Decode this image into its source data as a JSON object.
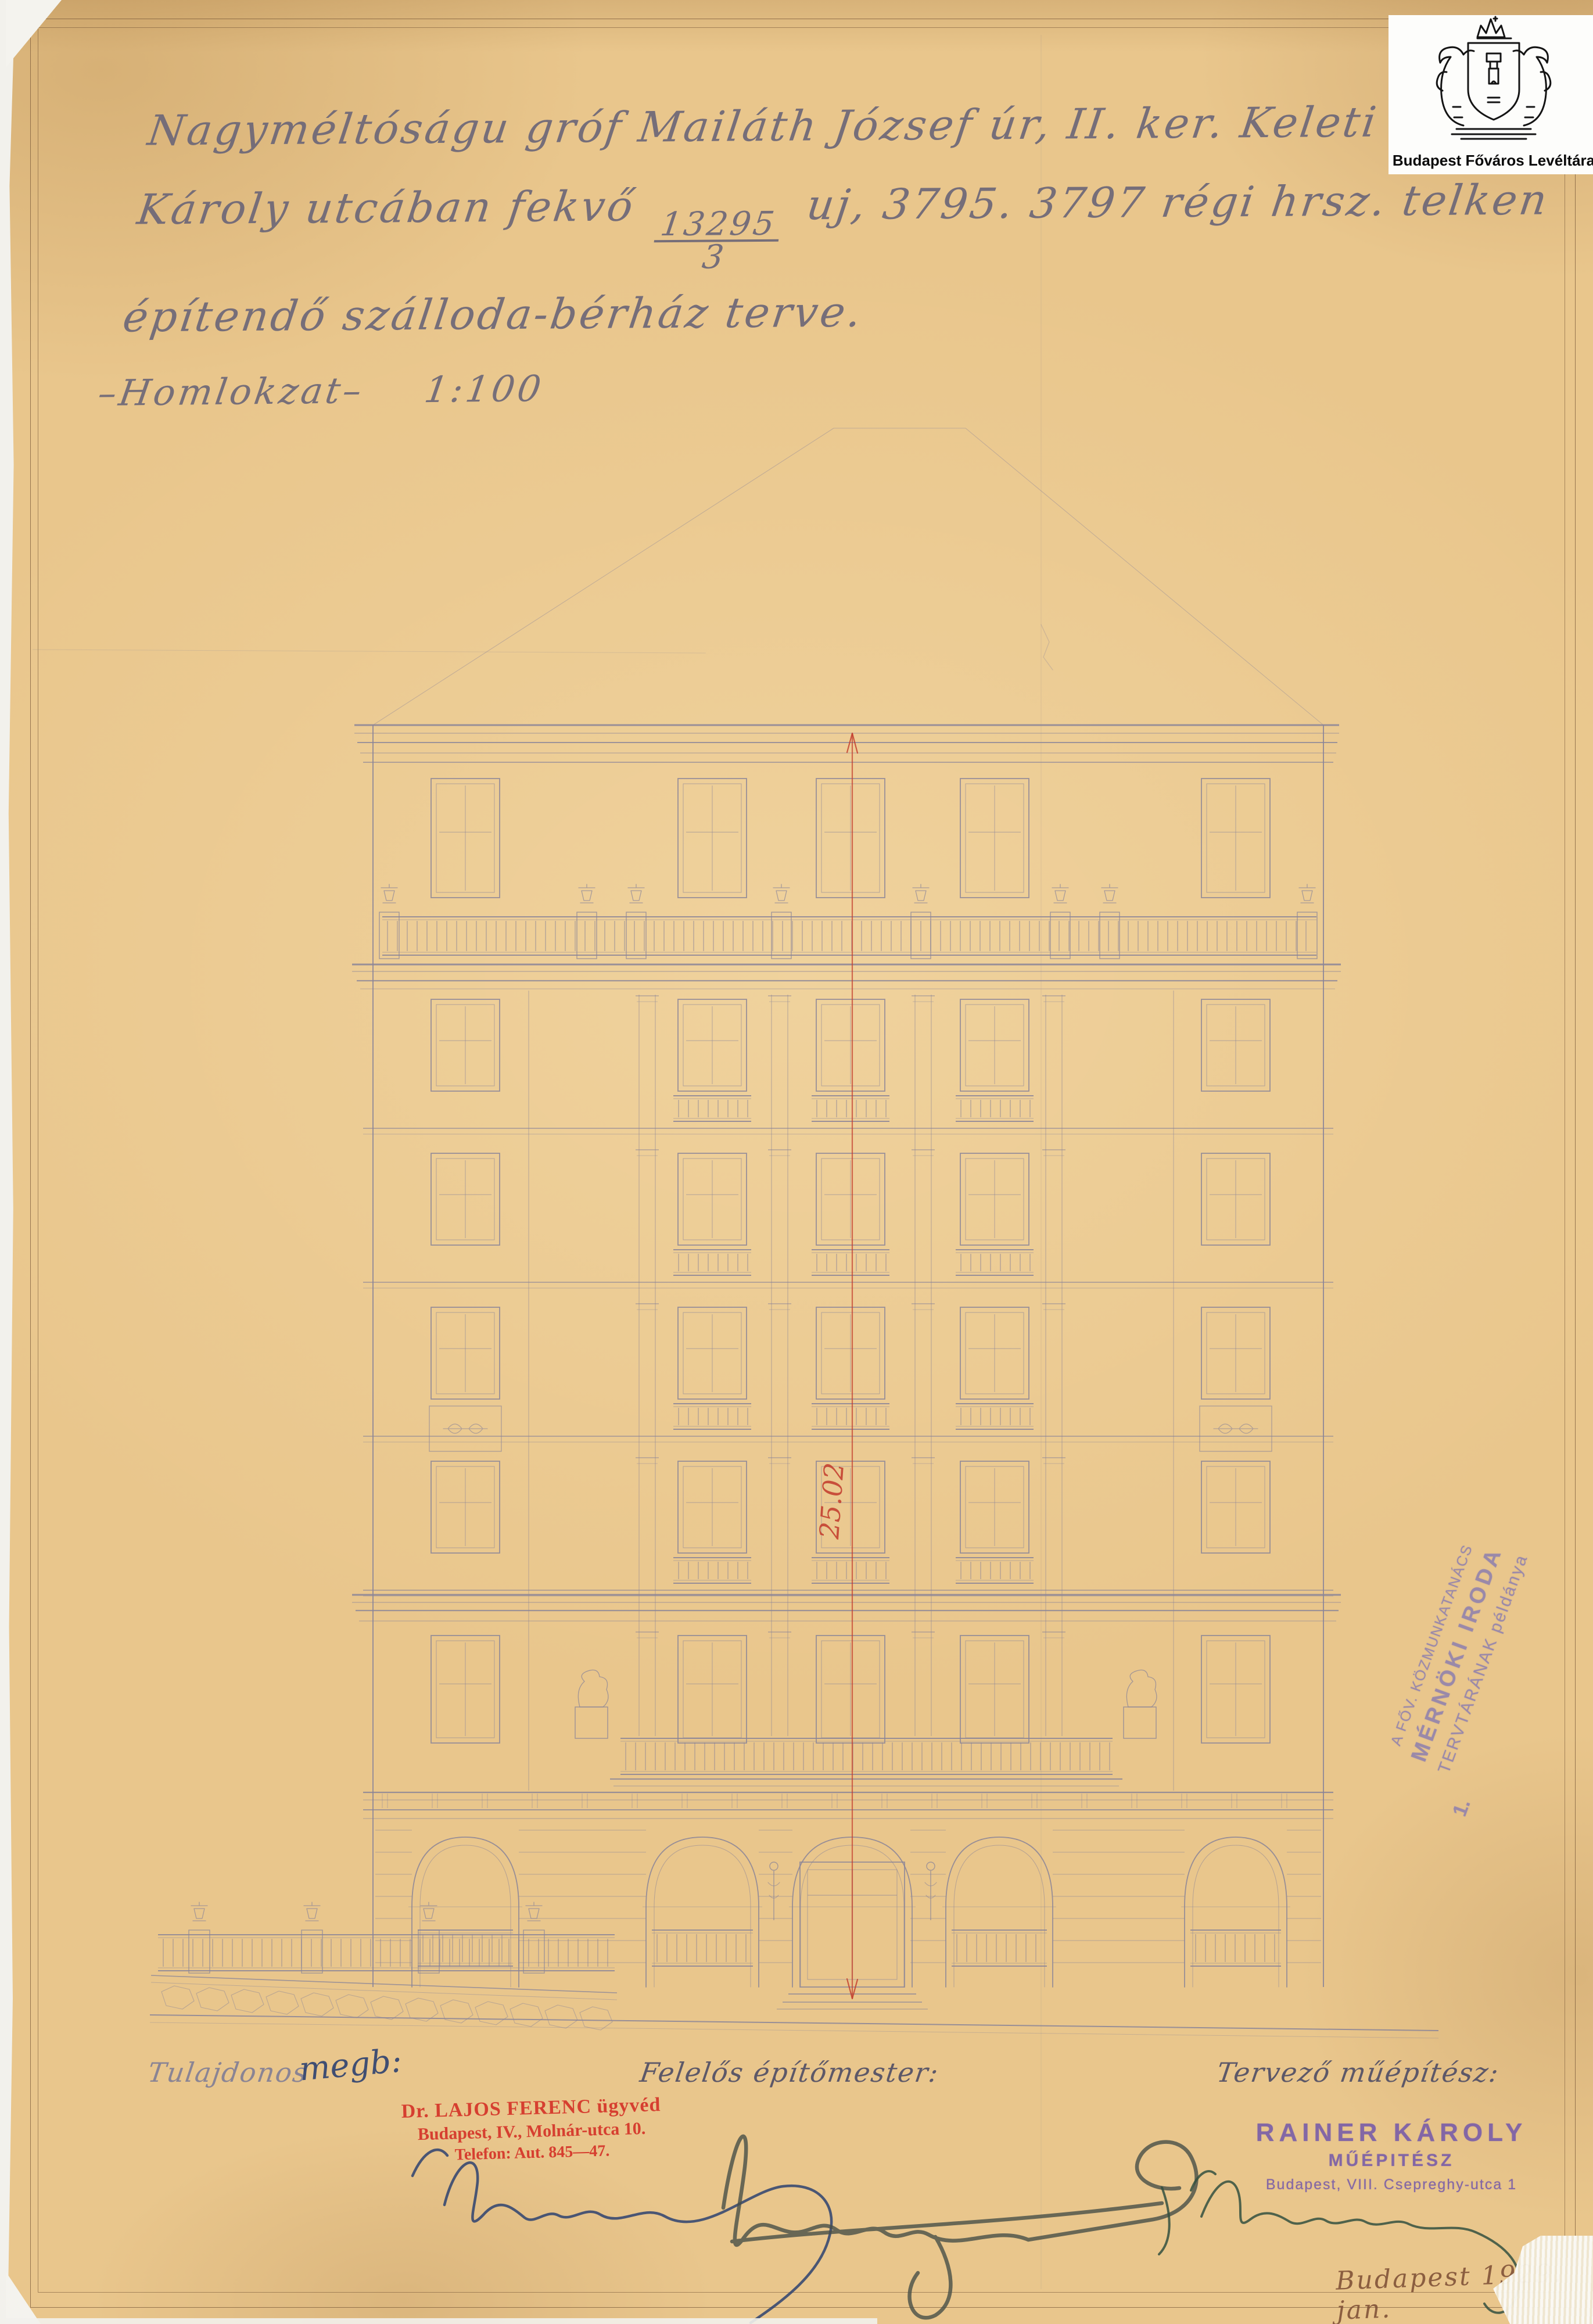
{
  "archive_logo": {
    "text": "Budapest Főváros Levéltára"
  },
  "title": {
    "line1": "Nagyméltóságu gróf Mailáth József úr, II. ker. Keleti ~",
    "line2_pre": "Károly utcában fekvő",
    "fraction": {
      "numerator": "13295",
      "denominator": "3"
    },
    "line2_post": "uj, 3795. 3797 régi hrsz. telken",
    "line3": "építendő szálloda-bérház terve."
  },
  "drawing_label": {
    "text": "–Homlokzat–",
    "scale": "1:100"
  },
  "dimension": {
    "value": "25.02"
  },
  "archive_stamp": {
    "line1": "A FŐV. KÖZMUNKATANÁCS",
    "line2": "MÉRNÖKI IRODA",
    "line3": "TERVTÁRÁNAK példánya",
    "number": "1."
  },
  "signatures": {
    "owner": {
      "label": "Tulajdonos",
      "note": "megb:",
      "stamp": [
        "Dr. LAJOS FERENC ügyvéd",
        "Budapest, IV., Molnár-utca 10.",
        "Telefon: Aut. 845—47."
      ]
    },
    "builder": {
      "label": "Felelős építőmester:"
    },
    "architect": {
      "label": "Tervező műépítész:",
      "stamp": [
        "RAINER KÁROLY",
        "MŰÉPITÉSZ",
        "Budapest, VIII. Csepreghy-utca 1"
      ]
    }
  },
  "date_note": "Budapest 1929. jan.",
  "colors": {
    "paper": "#e9c68c",
    "pencil": "#8a8498",
    "ink_blue": "#2e4270",
    "ink_dark": "#474f47",
    "ink_green": "#34503f",
    "red": "#c23a2b",
    "stamp_red": "#d5372b",
    "stamp_purple": "#7b5fa8",
    "stamp_purple_light": "#8578b2",
    "ink_brown": "#7b4c33",
    "frame": "#7a5a3a"
  }
}
